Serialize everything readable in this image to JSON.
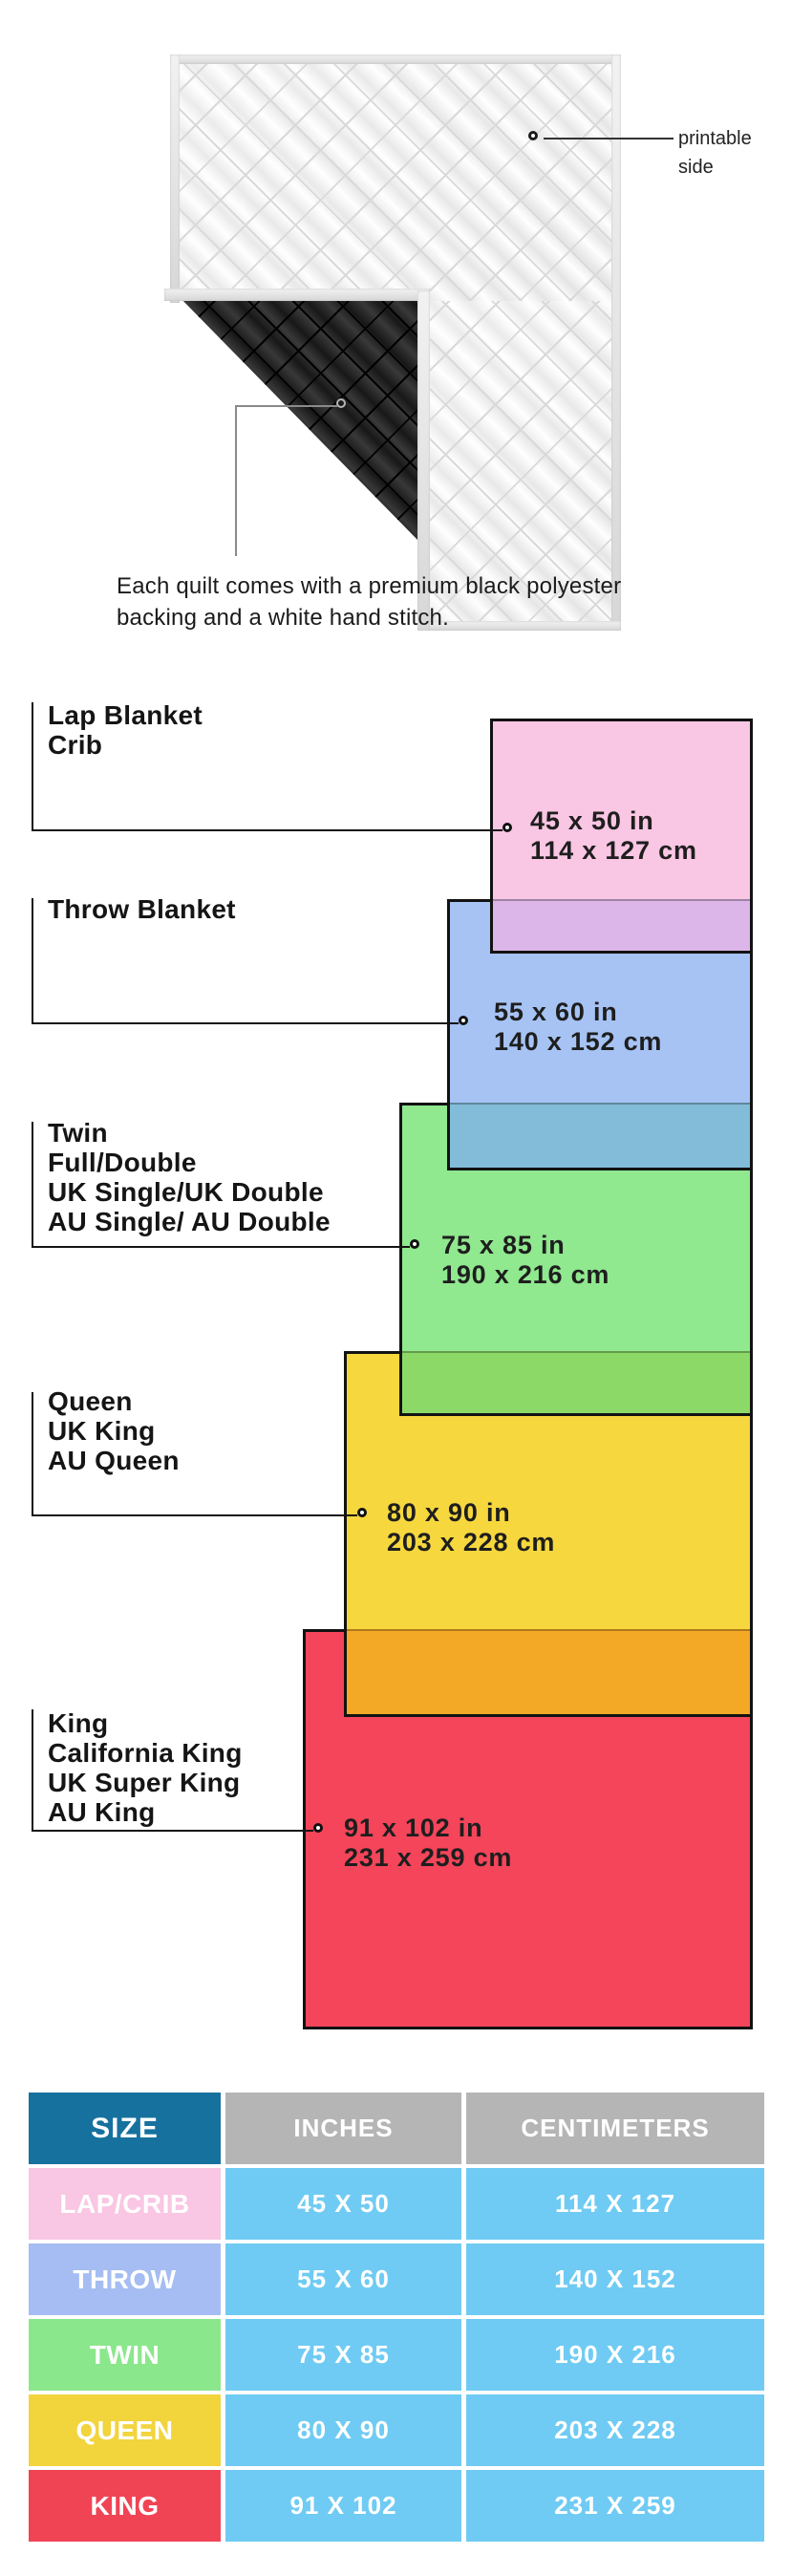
{
  "intro": {
    "printable_line1": "printable",
    "printable_line2": "side",
    "caption_line1": "Each quilt comes with a premium black polyester",
    "caption_line2": "backing and a white hand stitch."
  },
  "diagram": {
    "sizes": [
      {
        "id": "lap",
        "labels": [
          "Lap Blanket",
          "Crib"
        ],
        "inches": "45 x 50 in",
        "centimeters": "114 x 127 cm",
        "fill": "#f9c6e3",
        "overlap_fill": "#dcb6e8"
      },
      {
        "id": "throw",
        "labels": [
          "Throw Blanket"
        ],
        "inches": "55 x 60 in",
        "centimeters": "140 x 152 cm",
        "fill": "#a6c3f4",
        "overlap_fill": "#83bcd9"
      },
      {
        "id": "twin",
        "labels": [
          "Twin",
          "Full/Double",
          "UK Single/UK Double",
          "AU Single/ AU Double"
        ],
        "inches": "75 x 85 in",
        "centimeters": "190 x 216 cm",
        "fill": "#90e88f",
        "overlap_fill": "#8dd968"
      },
      {
        "id": "queen",
        "labels": [
          "Queen",
          "UK King",
          "AU Queen"
        ],
        "inches": "80 x 90 in",
        "centimeters": "203 x 228 cm",
        "fill": "#f6d73e",
        "overlap_fill": "#f3a826"
      },
      {
        "id": "king",
        "labels": [
          "King",
          "California King",
          "UK Super King",
          "AU King"
        ],
        "inches": "91 x 102 in",
        "centimeters": "231 x 259 cm",
        "fill": "#f4455a",
        "overlap_fill": null
      }
    ]
  },
  "table": {
    "headers": [
      "SIZE",
      "INCHES",
      "CENTIMETERS"
    ],
    "header_size_bg": "#16719e",
    "header_other_bg": "#b5b5b5",
    "cell_bg": "#6fcbf3",
    "rows": [
      {
        "size": "LAP/CRIB",
        "inches": "45 X 50",
        "centimeters": "114 X 127",
        "color": "#f9c6e3"
      },
      {
        "size": "THROW",
        "inches": "55 X 60",
        "centimeters": "140 X 152",
        "color": "#a5bdf2"
      },
      {
        "size": "TWIN",
        "inches": "75 X 85",
        "centimeters": "190 X 216",
        "color": "#8be78c"
      },
      {
        "size": "QUEEN",
        "inches": "80 X 90",
        "centimeters": "203 X 228",
        "color": "#f2d43d"
      },
      {
        "size": "KING",
        "inches": "91 X 102",
        "centimeters": "231 X 259",
        "color": "#f04455"
      }
    ]
  }
}
